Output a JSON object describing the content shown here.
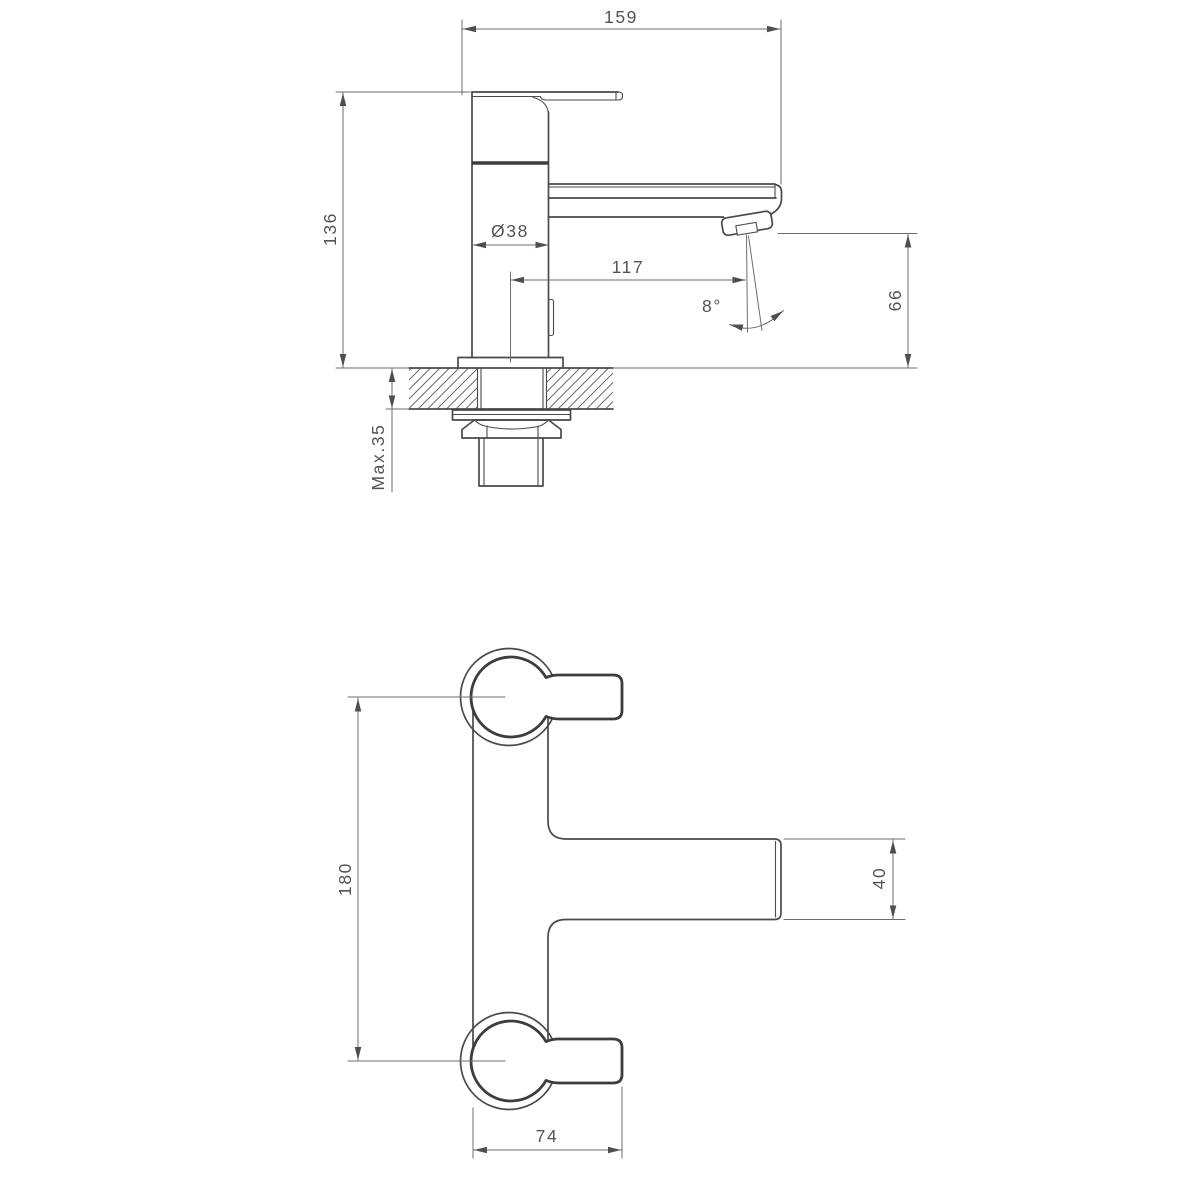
{
  "side_view": {
    "dims": {
      "overall_length": "159",
      "overall_height": "136",
      "body_diameter": "Ø38",
      "outlet_reach": "117",
      "outlet_height": "66",
      "spray_angle": "8°",
      "max_deck_thickness": "Max.35"
    }
  },
  "plan_view": {
    "dims": {
      "handle_centres": "180",
      "spout_width": "40",
      "body_length": "74"
    }
  },
  "style": {
    "object_line_color": "#4a4a4a",
    "bold_line_color": "#3d3d3d",
    "dimension_line_color": "#6e6e6e",
    "text_color": "#545454",
    "background": "#ffffff"
  }
}
